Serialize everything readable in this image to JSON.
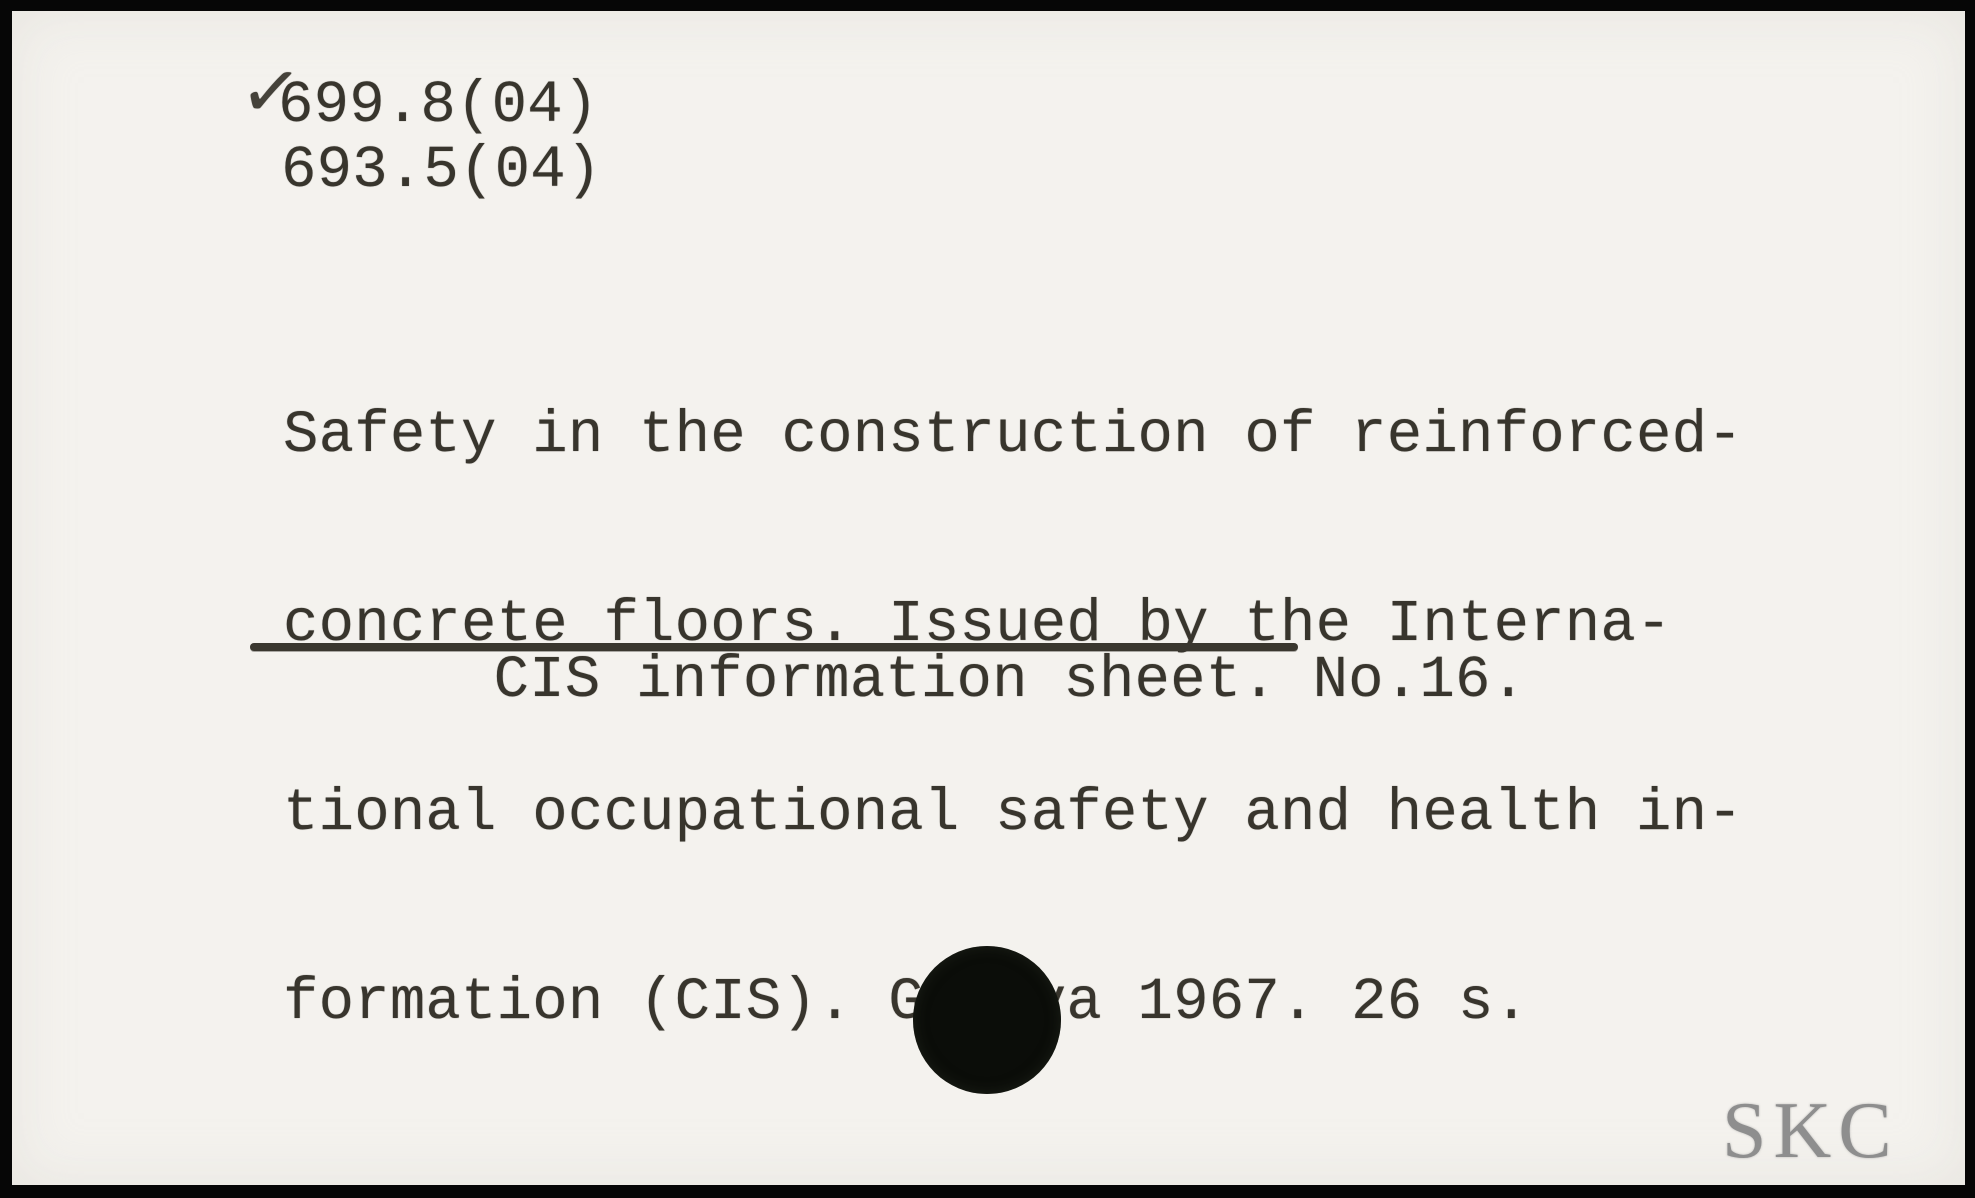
{
  "card": {
    "checkmark": "✓",
    "classification_codes": [
      "699.8(04)",
      "693.5(04)"
    ],
    "body_lines": [
      "Safety in the construction of reinforced-",
      "concrete floors. Issued by the Interna-",
      "tional occupational safety and health in-",
      "formation (CIS). Geneva 1967. 26 s."
    ],
    "series_underlined": "CIS information sheet. No.16",
    "series_suffix": ".",
    "stamp": "SKC"
  },
  "colors": {
    "ink": "#38352d",
    "paper": "#f4f2ee",
    "frame": "#060606",
    "stamp_gray": "#8e8e8e",
    "hole_black": "#0b0d09"
  }
}
